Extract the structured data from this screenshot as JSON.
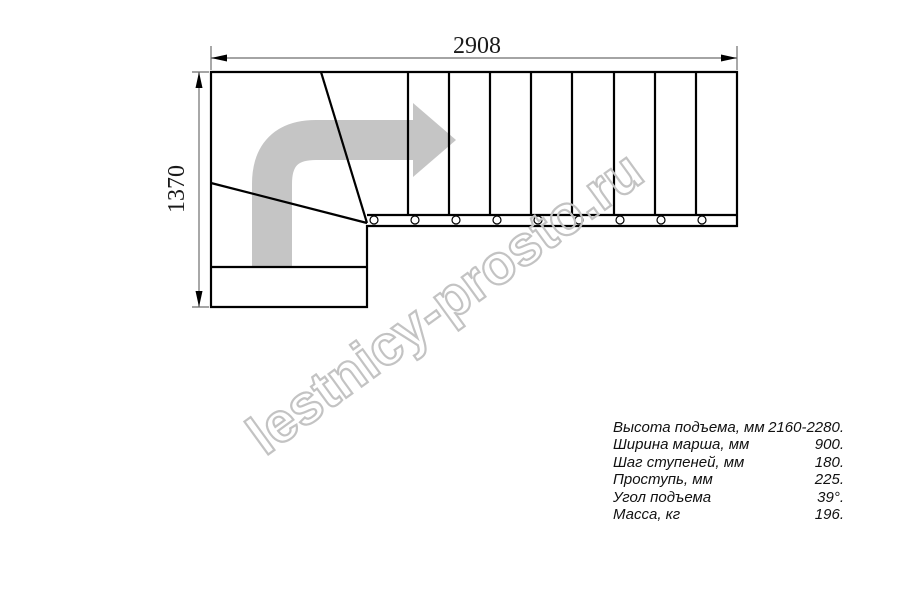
{
  "diagram": {
    "title_hidden": "",
    "dimensions": {
      "width_label": "2908",
      "height_label": "1370"
    },
    "straight_run_treads": 9,
    "winder_treads": 2,
    "fastener_circles": 9
  },
  "watermark": {
    "text": "lestnicy-prosto.ru"
  },
  "specs": {
    "rows": [
      {
        "label": "Высота подъема, мм",
        "value": "2160-2280."
      },
      {
        "label": "Ширина марша, мм",
        "value": "900."
      },
      {
        "label": "Шаг ступеней, мм",
        "value": "180."
      },
      {
        "label": "Проступь, мм",
        "value": "225."
      },
      {
        "label": "Угол подъема",
        "value": "39°."
      },
      {
        "label": "Масса, кг",
        "value": "196."
      }
    ]
  },
  "colors": {
    "plan_line": "#000000",
    "dimension_line": "#6e6e6e",
    "arrow_gray": "#c5c5c5",
    "watermark_gray": "#c3c3c3",
    "background": "#ffffff"
  }
}
